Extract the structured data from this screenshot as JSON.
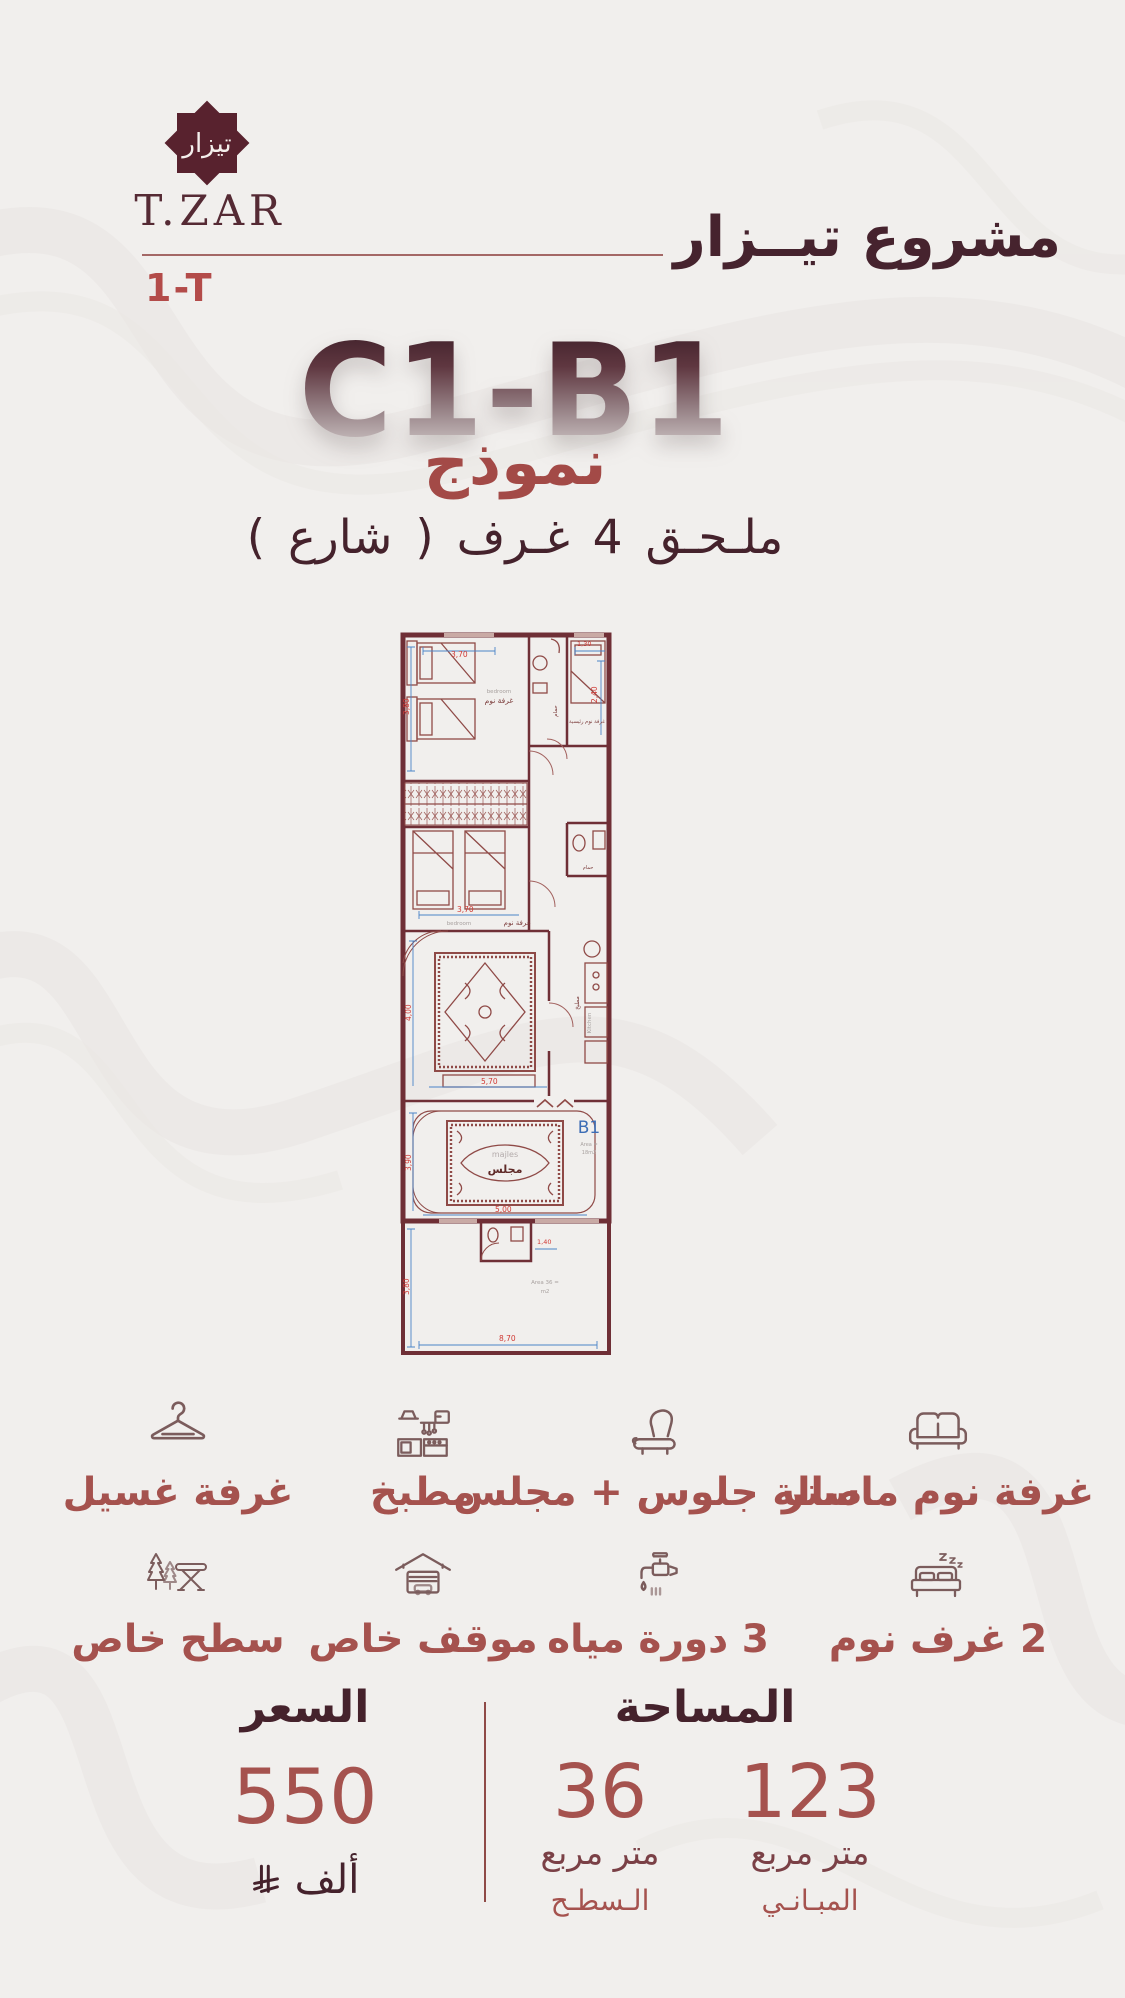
{
  "brand": {
    "logo_arabic": "تيزار",
    "logo_latin": "T.ZAR",
    "unit_code": "1-T",
    "project_title": "مشروع تيــزار"
  },
  "model": {
    "code": "C1-B1",
    "label": "نموذج",
    "subtitle": "ملـحـق 4 غـرف ( شارع )"
  },
  "floor_plan": {
    "unit": "B1",
    "rooms": {
      "bedroom_ar": "غرفة نوم",
      "bedroom_en": "bedroom",
      "master_ar": "غرفة نوم رئيسية",
      "bath_ar": "حمام",
      "kitchen_ar": "مطبخ",
      "kitchen_en": "Kitchen",
      "majles_ar": "مجلس",
      "majles_en": "majles",
      "area_majles_line1": "Area =",
      "area_majles_line2": "18m2",
      "area_roof_line1": "Area 36 =",
      "area_roof_line2": "m2"
    },
    "dims": {
      "bed1_w": "3,70",
      "bed1_h": "3,80",
      "entry": "1,30",
      "bath_h": "2,40",
      "bed2_w": "3,70",
      "living_h": "4,00",
      "living_w": "5,70",
      "majles_h": "3,90",
      "majles_w": "5,00",
      "bath2_w": "1,40",
      "roof_h": "3,80",
      "roof_w": "8,70"
    }
  },
  "features": {
    "row1": [
      {
        "icon": "hanger-icon",
        "label": "غرفة غسيل"
      },
      {
        "icon": "kitchen-icon",
        "label": "مطبخ"
      },
      {
        "icon": "armchair-icon",
        "label": "صالة جلوس + مجلس"
      },
      {
        "icon": "sofa-icon",
        "label": "غرفة نوم ماستر"
      }
    ],
    "row2": [
      {
        "icon": "picnic-trees-icon",
        "label": "سطح خاص"
      },
      {
        "icon": "garage-icon",
        "label": "موقف خاص"
      },
      {
        "icon": "faucet-icon",
        "label": "3 دورة مياه"
      },
      {
        "icon": "bed-icon",
        "label": "2 غرف نوم"
      }
    ]
  },
  "pricing": {
    "title": "السعر",
    "value": "550",
    "unit": "ألف",
    "currency_icon": "saudi-riyal-symbol"
  },
  "area": {
    "title": "المساحة",
    "buildings": {
      "value": "123",
      "unit": "متر مربع",
      "label": "المبـانـي"
    },
    "roof": {
      "value": "36",
      "unit": "متر مربع",
      "label": "الـسطـح"
    }
  },
  "colors": {
    "background": "#f1efed",
    "dark_maroon": "#46232e",
    "brick": "#a5524e",
    "plan_wall": "#6f2f36",
    "dim_red": "#d03a35",
    "dim_blue": "#4a84c8",
    "unit_blue": "#3d6db5"
  }
}
